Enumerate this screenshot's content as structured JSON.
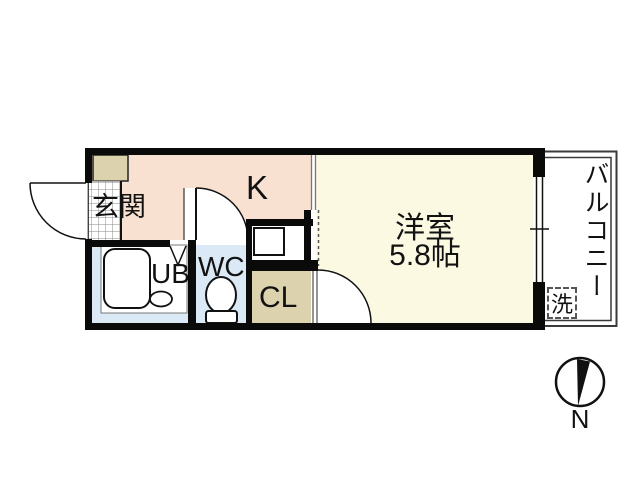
{
  "floor_plan": {
    "rooms": {
      "entrance": {
        "label": "玄関"
      },
      "kitchen": {
        "label": "K"
      },
      "western_room": {
        "label": "洋室",
        "size": "5.8帖"
      },
      "unit_bath": {
        "label": "UB"
      },
      "toilet": {
        "label": "WC"
      },
      "closet": {
        "label": "CL"
      },
      "balcony": {
        "label": "バルコニー"
      },
      "washing_machine": {
        "label": "洗"
      }
    },
    "compass": {
      "north_label": "N"
    },
    "colors": {
      "wall": "#0a0a0a",
      "kitchen_floor": "#f8e1d1",
      "western_room_floor": "#fcf9e3",
      "closet_and_cabinet": "#dcd2ad",
      "bath_and_toilet_floor": "#dae9f5",
      "balcony_outline": "#3a3a3a"
    }
  }
}
